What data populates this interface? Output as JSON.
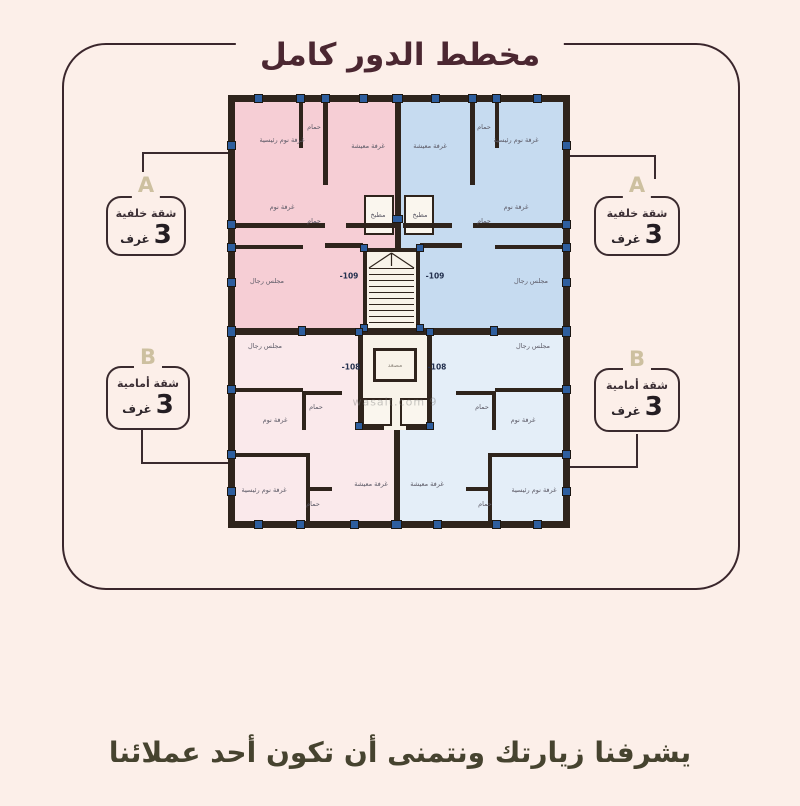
{
  "title": "مخطط الدور كامل",
  "footer": "يشرفنا زيارتك ونتمنى أن تكون أحد عملائنا",
  "annotations": [
    {
      "letter": "A",
      "type": "شقة خلفية",
      "count": "3",
      "unit": "غرف"
    },
    {
      "letter": "A",
      "type": "شقة خلفية",
      "count": "3",
      "unit": "غرف"
    },
    {
      "letter": "B",
      "type": "شقة أمامية",
      "count": "3",
      "unit": "غرف"
    },
    {
      "letter": "B",
      "type": "شقة أمامية",
      "count": "3",
      "unit": "غرف"
    }
  ],
  "plan": {
    "doors": [
      "-109",
      "-109",
      "-108",
      "-108"
    ],
    "elevator_label": "مصعد",
    "watermark": "wasalt.com 9",
    "rooms": [
      {
        "label": "غرفة نوم رئيسية"
      },
      {
        "label": "حمام"
      },
      {
        "label": "غرفة معيشة"
      },
      {
        "label": "غرفة نوم"
      },
      {
        "label": "حمام"
      },
      {
        "label": "مطبخ"
      },
      {
        "label": "مجلس رجال"
      },
      {
        "label": "غرفة معيشة"
      },
      {
        "label": "حمام"
      },
      {
        "label": "غرفة نوم رئيسية"
      },
      {
        "label": "غرفة نوم"
      },
      {
        "label": "حمام"
      },
      {
        "label": "مطبخ"
      },
      {
        "label": "مجلس رجال"
      },
      {
        "label": "مجلس رجال"
      },
      {
        "label": "غرفة نوم"
      },
      {
        "label": "حمام"
      },
      {
        "label": "غرفة نوم رئيسية"
      },
      {
        "label": "حمام"
      },
      {
        "label": "غرفة معيشة"
      },
      {
        "label": "مجلس رجال"
      },
      {
        "label": "غرفة نوم"
      },
      {
        "label": "حمام"
      },
      {
        "label": "غرفة نوم رئيسية"
      },
      {
        "label": "حمام"
      },
      {
        "label": "غرفة معيشة"
      }
    ]
  },
  "colors": {
    "background": "#fcefe9",
    "frame": "#3a262c",
    "title": "#4b2731",
    "quad_top_left": "#f6ced5",
    "quad_top_right": "#c6dbf0",
    "quad_bottom_left": "#fae9eb",
    "quad_bottom_right": "#e4eef8",
    "wall": "#2f241c",
    "column": "#2e5e9e",
    "letter": "#cdc0a0"
  }
}
